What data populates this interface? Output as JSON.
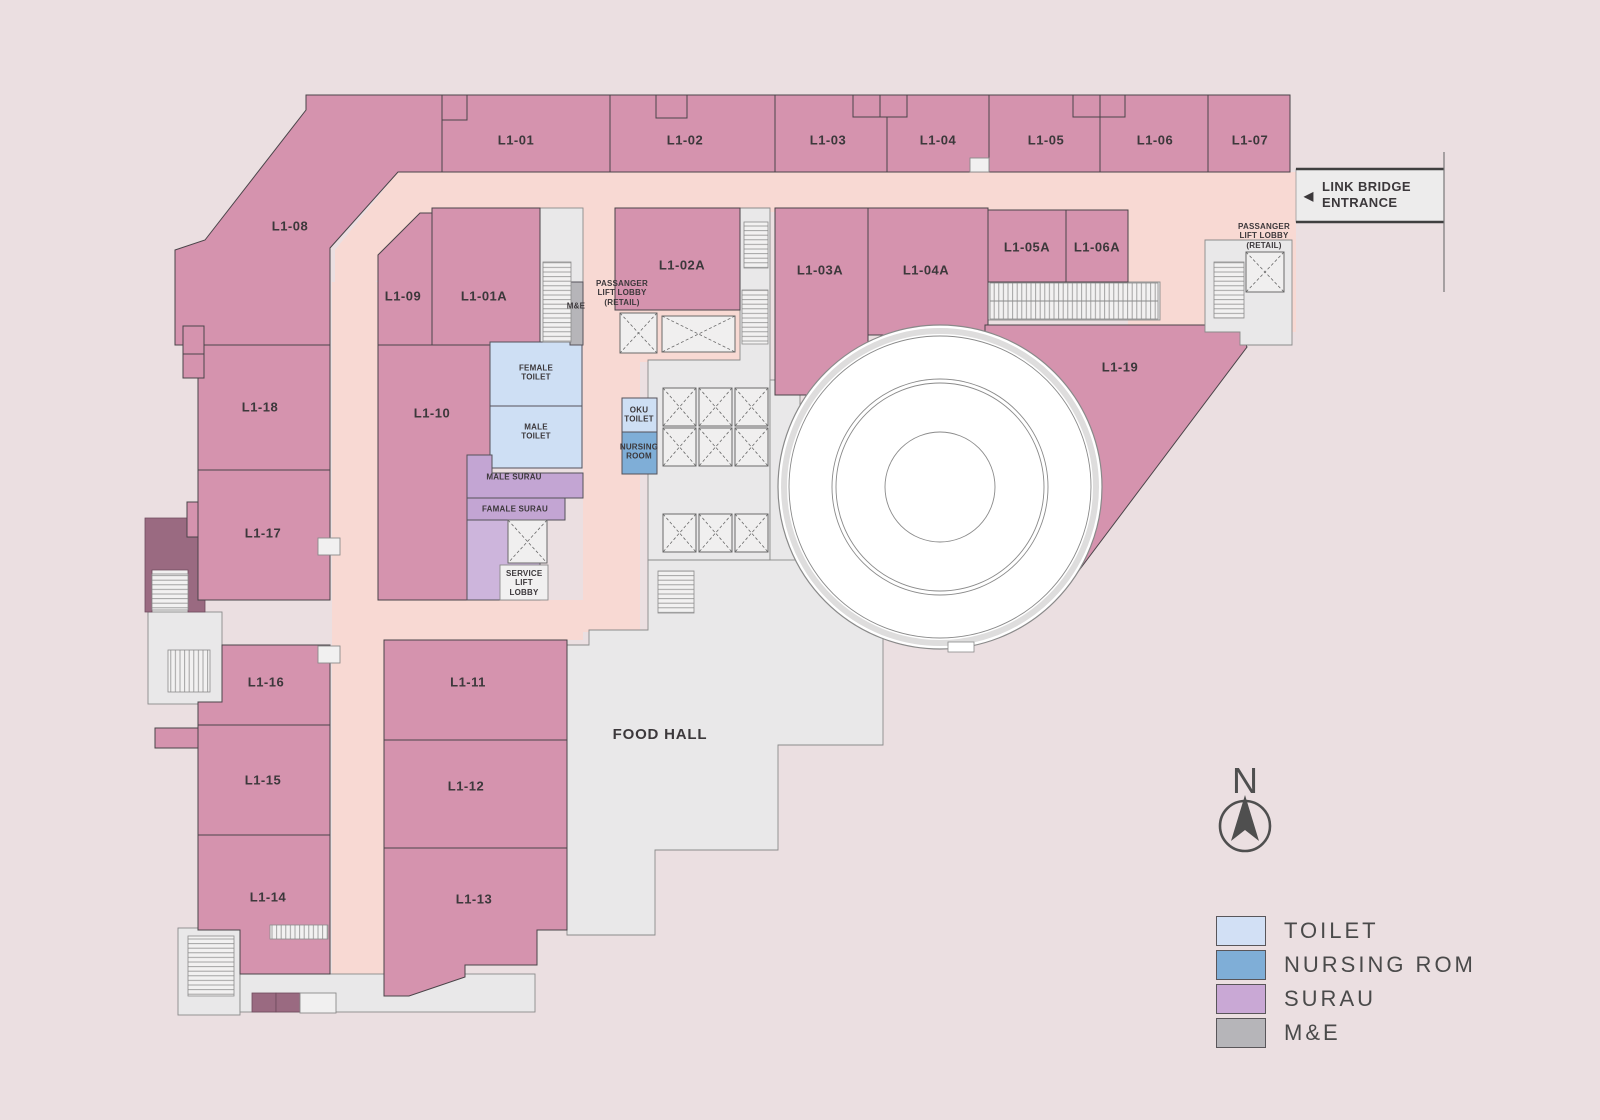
{
  "units": [
    {
      "id": "L1-01",
      "label": "L1-01"
    },
    {
      "id": "L1-02",
      "label": "L1-02"
    },
    {
      "id": "L1-03",
      "label": "L1-03"
    },
    {
      "id": "L1-04",
      "label": "L1-04"
    },
    {
      "id": "L1-05",
      "label": "L1-05"
    },
    {
      "id": "L1-06",
      "label": "L1-06"
    },
    {
      "id": "L1-07",
      "label": "L1-07"
    },
    {
      "id": "L1-08",
      "label": "L1-08"
    },
    {
      "id": "L1-09",
      "label": "L1-09"
    },
    {
      "id": "L1-01A",
      "label": "L1-01A"
    },
    {
      "id": "L1-02A",
      "label": "L1-02A"
    },
    {
      "id": "L1-03A",
      "label": "L1-03A"
    },
    {
      "id": "L1-04A",
      "label": "L1-04A"
    },
    {
      "id": "L1-05A",
      "label": "L1-05A"
    },
    {
      "id": "L1-06A",
      "label": "L1-06A"
    },
    {
      "id": "L1-10",
      "label": "L1-10"
    },
    {
      "id": "L1-11",
      "label": "L1-11"
    },
    {
      "id": "L1-12",
      "label": "L1-12"
    },
    {
      "id": "L1-13",
      "label": "L1-13"
    },
    {
      "id": "L1-14",
      "label": "L1-14"
    },
    {
      "id": "L1-15",
      "label": "L1-15"
    },
    {
      "id": "L1-16",
      "label": "L1-16"
    },
    {
      "id": "L1-17",
      "label": "L1-17"
    },
    {
      "id": "L1-18",
      "label": "L1-18"
    },
    {
      "id": "L1-19",
      "label": "L1-19"
    }
  ],
  "facilities": {
    "female_toilet": "FEMALE TOILET",
    "male_toilet": "MALE TOILET",
    "male_surau": "MALE SURAU",
    "famale_surau": "FAMALE SURAU",
    "service_lift_lobby": "SERVICE LIFT LOBBY",
    "oku_toilet": "OKU TOILET",
    "nursing_room": "NURSING ROOM",
    "me": "M&E",
    "passenger_lift_lobby_retail": "PASSANGER LIFT LOBBY (RETAIL)",
    "food_hall": "FOOD HALL"
  },
  "entrance": {
    "label": "LINK BRIDGE ENTRANCE",
    "arrow": "◀"
  },
  "compass": {
    "label": "N"
  },
  "legend": {
    "items": [
      {
        "label": "TOILET",
        "color": "#D2E0F5"
      },
      {
        "label": "NURSING ROM",
        "color": "#7FAED7"
      },
      {
        "label": "SURAU",
        "color": "#C9A8D5"
      },
      {
        "label": "M&E",
        "color": "#B6B5B9"
      }
    ]
  },
  "colors": {
    "background": "#EBDFE1",
    "retail_unit": "#D593AE",
    "corridor": "#F8D9D3",
    "back_of_house": "#E9E8E9",
    "toilet": "#CEDFF4",
    "nursing_room": "#7FAED7",
    "surau": "#C3A5D3",
    "service_lobby": "#CDB5DC",
    "me": "#B6B5B9",
    "accent_dark": "#9A6A81"
  }
}
